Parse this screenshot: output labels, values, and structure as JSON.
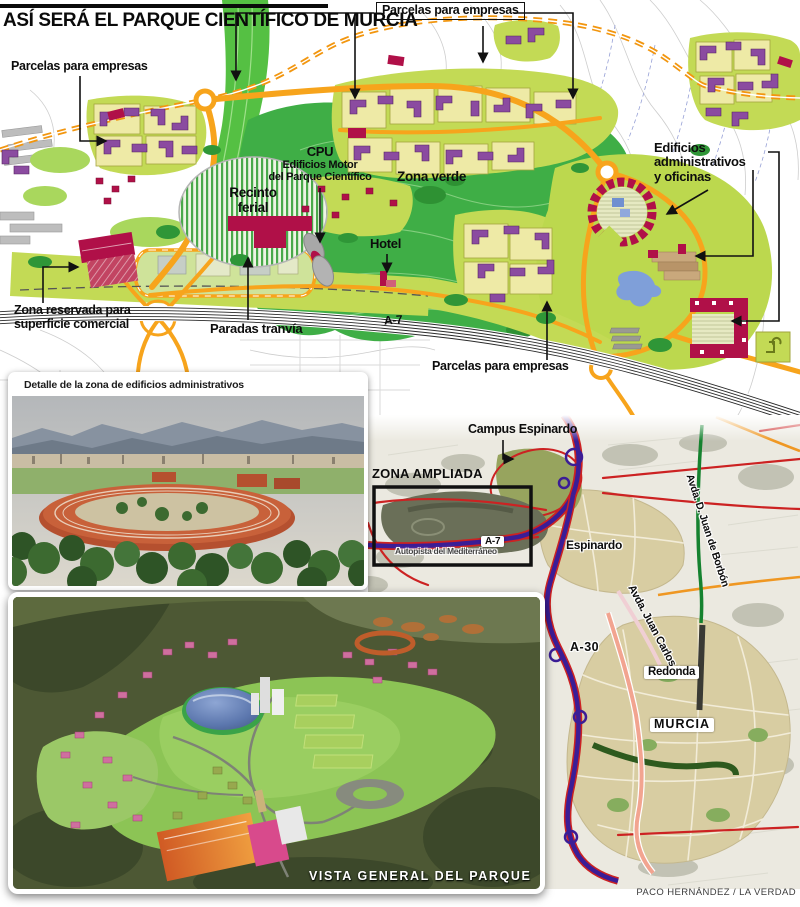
{
  "title": "ASÍ SERÁ EL PARQUE CIENTÍFICO DE MURCIA",
  "credit": "PACO HERNÁNDEZ / LA VERDAD",
  "colors": {
    "accent_orange": "#f7a41c",
    "dashed_orange": "#f2960f",
    "park_green": "#3fae46",
    "corridor_green": "#55c043",
    "lime_zone": "#c3da55",
    "parcel_yellow": "#eeeaa6",
    "building_purple": "#8b4ba0",
    "building_crimson": "#b01048",
    "motorway_indigo": "#3b1d96",
    "road_red": "#cc2222",
    "road_salmon": "#f2a490",
    "road_green": "#15822f",
    "water_blue": "#7f9fd9",
    "city_tan": "#d8cda2"
  },
  "main_map": {
    "labels": {
      "parcelas_left": "Parcelas para empresas",
      "parcelas_top": "Parcelas para empresas",
      "parcelas_bottom": "Parcelas para empresas",
      "cpu_title": "CPU",
      "cpu_line2": "Edificios Motor",
      "cpu_line3": "del Parque Científico",
      "zona_verde": "Zona verde",
      "recinto_line1": "Recinto",
      "recinto_line2": "ferial",
      "hotel": "Hotel",
      "admin_line1": "Edificios",
      "admin_line2": "administrativos",
      "admin_line3": "y oficinas",
      "comercial_line1": "Zona reservada para",
      "comercial_line2": "superficie comercial",
      "tranvia": "Paradas tranvía",
      "a7": "A-7"
    }
  },
  "detail_photo": {
    "caption": "Detalle de la zona de edificios administrativos"
  },
  "area_map": {
    "labels": {
      "campus": "Campus Espinardo",
      "zona_ampliada": "ZONA AMPLIADA",
      "autopista": "Autopista del Mediterráneo",
      "a7": "A-7",
      "espinardo": "Espinardo",
      "avda_borbon": "Avda. D. Juan de Borbón",
      "avda_juan_carlos": "Avda. Juan Carlos I",
      "a30": "A-30",
      "redonda": "Redonda",
      "murcia": "MURCIA"
    }
  },
  "overview": {
    "caption": "VISTA GENERAL DEL PARQUE"
  }
}
